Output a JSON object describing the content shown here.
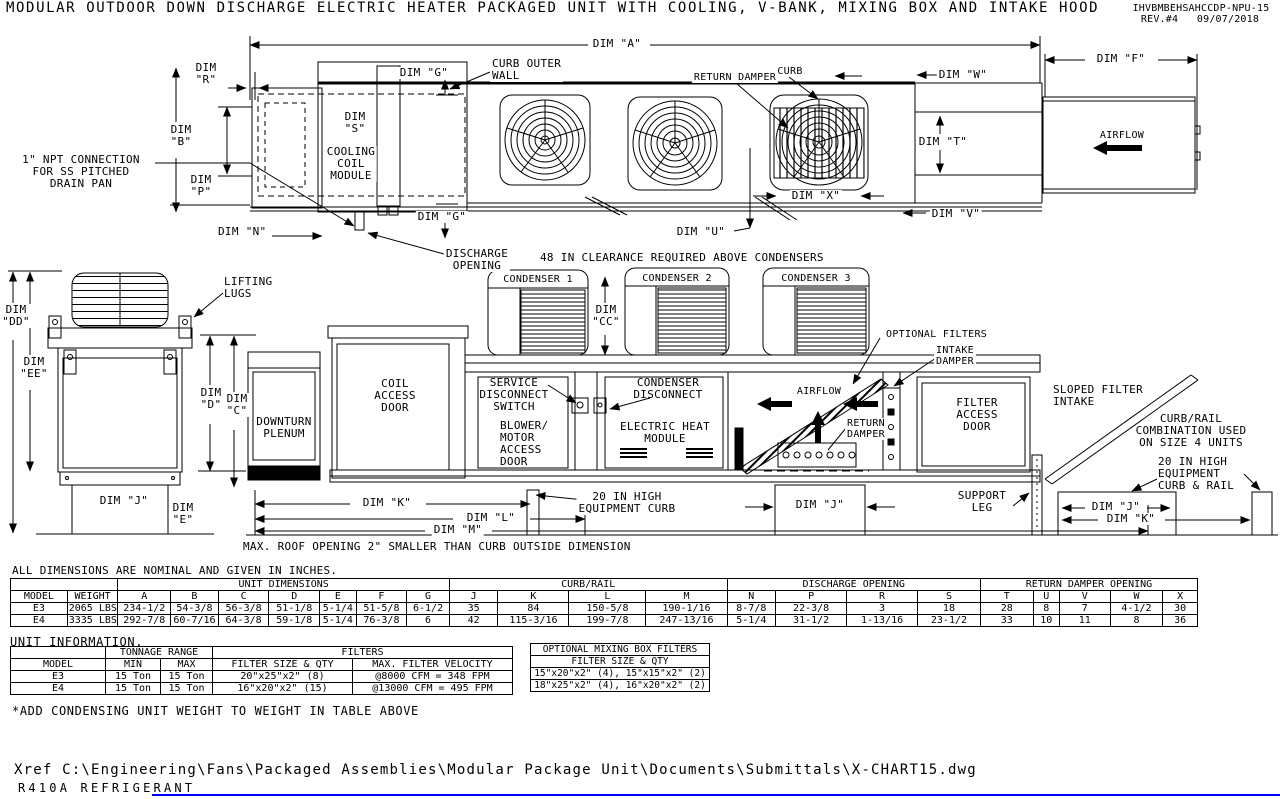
{
  "header": {
    "title": "MODULAR OUTDOOR DOWN DISCHARGE ELECTRIC HEATER PACKAGED UNIT WITH COOLING, V-BANK, MIXING BOX AND INTAKE HOOD",
    "doc_number": "IHVBMBEHSAHCCDP-NPU-15",
    "revision": "REV.#4   09/07/2018"
  },
  "colors": {
    "line": "#000000",
    "accent_line": "#0000ff"
  },
  "plan": {
    "dims": {
      "a": "DIM \"A\"",
      "f": "DIM \"F\"",
      "r": "DIM\n\"R\"",
      "b": "DIM\n\"B\"",
      "p": "DIM\n\"P\"",
      "n": "DIM \"N\"",
      "s": "DIM\n\"S\"",
      "g_top": "DIM \"G\"",
      "g_bot": "DIM \"G\"",
      "w": "DIM \"W\"",
      "t": "DIM \"T\"",
      "v": "DIM \"V\"",
      "u": "DIM \"U\"",
      "x": "DIM \"X\""
    },
    "labels": {
      "curb_outer_wall": "CURB OUTER\nWALL",
      "cooling_coil_module": "COOLING\nCOIL\nMODULE",
      "return_damper": "RETURN DAMPER",
      "curb": "CURB",
      "airflow": "AIRFLOW",
      "npt": "1\" NPT CONNECTION\nFOR SS PITCHED\nDRAIN PAN",
      "discharge_opening": "DISCHARGE\nOPENING",
      "clearance_note": "48 IN CLEARANCE REQUIRED ABOVE CONDENSERS"
    }
  },
  "elevation": {
    "dims": {
      "dd": "DIM\n\"DD\"",
      "ee": "DIM\n\"EE\"",
      "d": "DIM\n\"D\"",
      "c": "DIM\n\"C\"",
      "e": "DIM\n\"E\"",
      "j_left": "DIM \"J\"",
      "cc": "DIM\n\"CC\"",
      "k": "DIM \"K\"",
      "l": "DIM \"L\"",
      "m": "DIM \"M\"",
      "j_mid": "DIM \"J\"",
      "j_right": "DIM \"J\"",
      "k_right": "DIM \"K\""
    },
    "labels": {
      "lifting_lugs": "LIFTING\nLUGS",
      "downturn_plenum": "DOWNTURN\nPLENUM",
      "coil_access_door": "COIL\nACCESS\nDOOR",
      "condenser_1": "CONDENSER 1",
      "condenser_2": "CONDENSER 2",
      "condenser_3": "CONDENSER 3",
      "service_disconnect": "SERVICE\nDISCONNECT\nSWITCH",
      "blower_motor": "BLOWER/\nMOTOR\nACCESS\nDOOR",
      "condenser_disconnect": "CONDENSER\nDISCONNECT",
      "electric_heat": "ELECTRIC HEAT\nMODULE",
      "optional_filters": "OPTIONAL FILTERS",
      "intake_damper": "INTAKE\nDAMPER",
      "airflow": "AIRFLOW",
      "return_damper": "RETURN\nDAMPER",
      "filter_access_door": "FILTER\nACCESS\nDOOR",
      "support_leg": "SUPPORT\nLEG",
      "sloped_filter_intake": "SLOPED FILTER\nINTAKE",
      "curb_rail_combo": "CURB/RAIL\nCOMBINATION USED\nON SIZE 4 UNITS",
      "curb_rail_20": "20 IN HIGH\nEQUIPMENT\nCURB & RAIL",
      "equipment_curb_20": "20 IN HIGH\nEQUIPMENT CURB",
      "roof_note": "MAX. ROOF OPENING 2\" SMALLER THAN CURB OUTSIDE DIMENSION"
    }
  },
  "tables": {
    "dim": {
      "note": "ALL DIMENSIONS ARE NOMINAL AND GIVEN IN INCHES.",
      "groups": {
        "unit": "UNIT DIMENSIONS",
        "curb": "CURB/RAIL",
        "discharge": "DISCHARGE OPENING",
        "return_damper": "RETURN DAMPER OPENING"
      },
      "headers": [
        "MODEL",
        "WEIGHT",
        "A",
        "B",
        "C",
        "D",
        "E",
        "F",
        "G",
        "J",
        "K",
        "L",
        "M",
        "N",
        "P",
        "R",
        "S",
        "T",
        "U",
        "V",
        "W",
        "X"
      ],
      "rows": [
        [
          "E3",
          "2065 LBS",
          "234-1/2",
          "54-3/8",
          "56-3/8",
          "51-1/8",
          "5-1/4",
          "51-5/8",
          "6-1/2",
          "35",
          "84",
          "150-5/8",
          "190-1/16",
          "8-7/8",
          "22-3/8",
          "3",
          "18",
          "28",
          "8",
          "7",
          "4-1/2",
          "30"
        ],
        [
          "E4",
          "3335 LBS",
          "292-7/8",
          "60-7/16",
          "64-3/8",
          "59-1/8",
          "5-1/4",
          "76-3/8",
          "6",
          "42",
          "115-3/16",
          "199-7/8",
          "247-13/16",
          "5-1/4",
          "31-1/2",
          "1-13/16",
          "23-1/2",
          "33",
          "10",
          "11",
          "8",
          "36"
        ]
      ]
    },
    "info": {
      "title": "UNIT INFORMATION.",
      "groups": {
        "tonnage": "TONNAGE RANGE",
        "filters": "FILTERS"
      },
      "headers": [
        "MODEL",
        "MIN",
        "MAX",
        "FILTER SIZE & QTY",
        "MAX. FILTER VELOCITY"
      ],
      "rows": [
        [
          "E3",
          "15 Ton",
          "15 Ton",
          "20\"x25\"x2\" (8)",
          "@8000 CFM = 348 FPM"
        ],
        [
          "E4",
          "15 Ton",
          "15 Ton",
          "16\"x20\"x2\" (15)",
          "@13000 CFM = 495 FPM"
        ]
      ],
      "footnote": "*ADD CONDENSING UNIT WEIGHT TO WEIGHT IN TABLE ABOVE"
    },
    "mixing": {
      "title": "OPTIONAL MIXING BOX FILTERS",
      "header": "FILTER SIZE & QTY",
      "rows": [
        [
          "15\"x20\"x2\" (4), 15\"x15\"x2\" (2)"
        ],
        [
          "18\"x25\"x2\" (4), 16\"x20\"x2\" (2)"
        ]
      ]
    }
  },
  "footer": {
    "xref": "Xref C:\\Engineering\\Fans\\Packaged Assemblies\\Modular Package Unit\\Documents\\Submittals\\X-CHART15.dwg",
    "refrigerant": "R410A REFRIGERANT"
  }
}
